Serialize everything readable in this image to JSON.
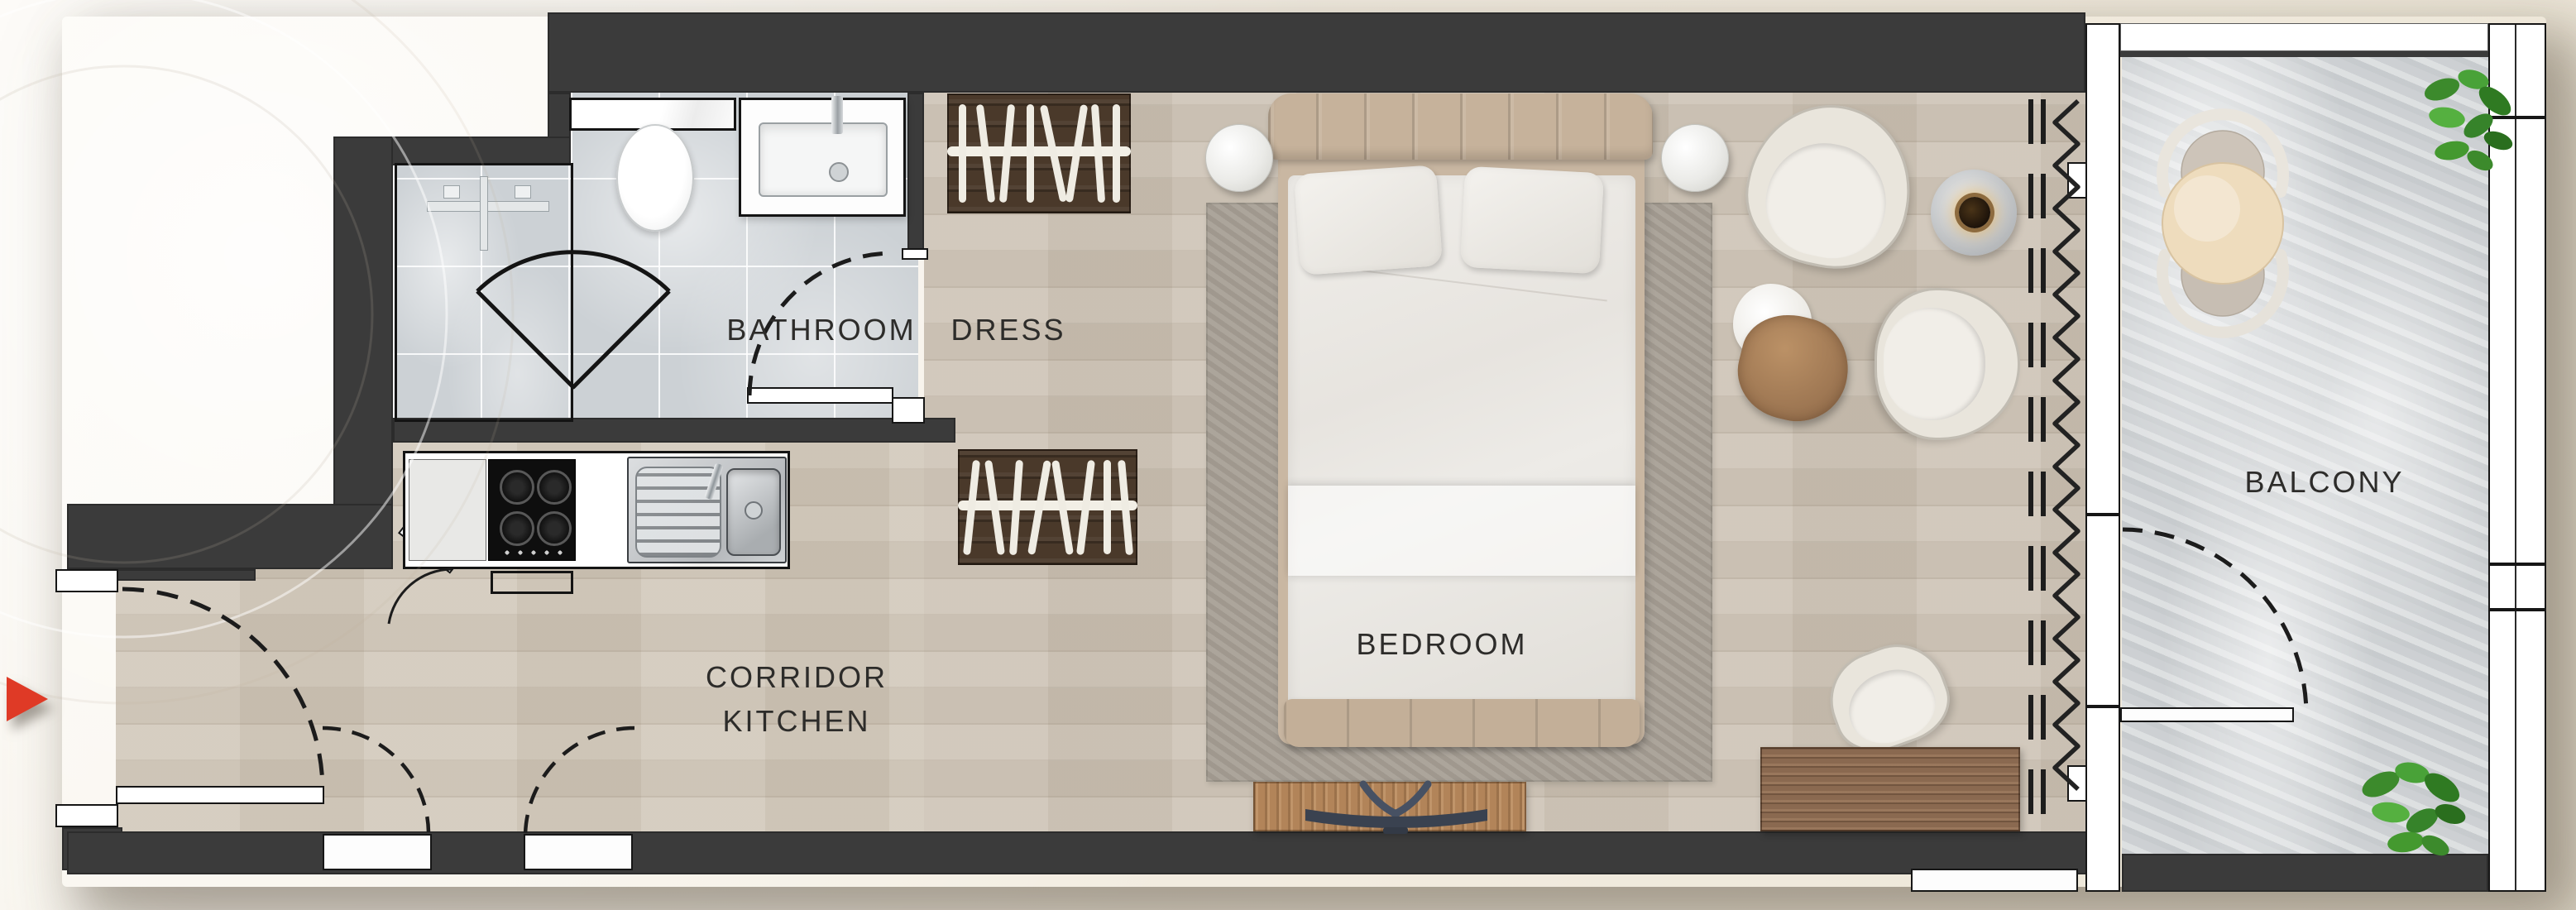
{
  "title": "Studio apartment floor plan",
  "rooms": {
    "bathroom": "BATHROOM",
    "dress": "DRESS",
    "corridor_line1": "CORRIDOR",
    "corridor_line2": "KITCHEN",
    "bedroom": "BEDROOM",
    "balcony": "BALCONY"
  },
  "icons": {
    "entrance_arrow": "red-right-triangle-entrance-marker",
    "window_symbol": "zigzag-and-dashed-curtain-lines",
    "hanger_symbol": "wardrobe-hanger-bars"
  },
  "colors": {
    "wall": "#3b3b3b",
    "background": "#f3eee4",
    "wood_floor": "#cdc3b5",
    "bathroom_tile": "#ccd1d5",
    "balcony_stone": "#d2d5d7",
    "rug": "#a8a096",
    "accent_red": "#df3a26",
    "wardrobe_wood": "#4a392a",
    "console_wood": "#b28459",
    "desk_wood": "#8a6950",
    "hob_black": "#111111",
    "sink_steel": "#c9ccce",
    "bed_frame": "#c6b29b",
    "duvet_white": "#eae8e3",
    "table_top": "#eedcbd",
    "plant_green": "#3f8f2f"
  }
}
